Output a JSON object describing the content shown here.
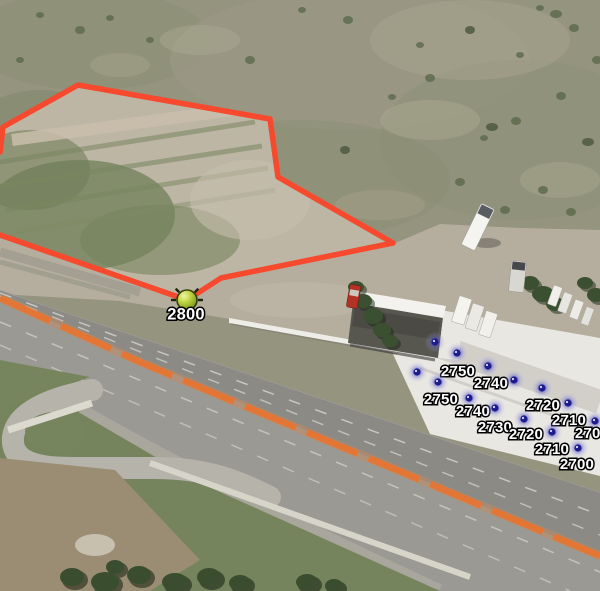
{
  "map": {
    "type": "satellite-aerial-view",
    "canvas": {
      "width": 600,
      "height": 591
    }
  },
  "colors": {
    "parcel_outline": "#f6492d",
    "elevation_marker_core": "#1c1c8e",
    "elevation_marker_glow": "#5656c6",
    "reference_marker_fill": "#abc437",
    "reference_marker_border": "#333f0c",
    "label_text": "#ffffff",
    "label_outline": "#000000",
    "highway_median_stripe": "#e8742f"
  },
  "parcel_outline": {
    "points": [
      [
        0,
        152
      ],
      [
        3,
        127
      ],
      [
        78,
        85
      ],
      [
        270,
        119
      ],
      [
        278,
        177
      ],
      [
        393,
        243
      ],
      [
        221,
        278
      ],
      [
        187,
        300
      ],
      [
        0,
        235
      ]
    ]
  },
  "reference_point": {
    "label": "2800",
    "x": 187,
    "y": 300,
    "label_x": 186,
    "label_y": 315
  },
  "elevation_points": [
    {
      "x": 435,
      "y": 342,
      "label": ""
    },
    {
      "x": 457,
      "y": 353,
      "label": "2750",
      "label_x": 458,
      "label_y": 372
    },
    {
      "x": 488,
      "y": 366,
      "label": "2740",
      "label_x": 491,
      "label_y": 384
    },
    {
      "x": 417,
      "y": 372,
      "label": ""
    },
    {
      "x": 438,
      "y": 382,
      "label": "2750",
      "label_x": 441,
      "label_y": 400
    },
    {
      "x": 514,
      "y": 380,
      "label": ""
    },
    {
      "x": 542,
      "y": 388,
      "label": "2720",
      "label_x": 543,
      "label_y": 406
    },
    {
      "x": 469,
      "y": 398,
      "label": "2740",
      "label_x": 473,
      "label_y": 412
    },
    {
      "x": 568,
      "y": 403,
      "label": "2710",
      "label_x": 569,
      "label_y": 421
    },
    {
      "x": 495,
      "y": 408,
      "label": "2730",
      "label_x": 495,
      "label_y": 428
    },
    {
      "x": 524,
      "y": 419,
      "label": "2720",
      "label_x": 526,
      "label_y": 435
    },
    {
      "x": 595,
      "y": 421,
      "label": "2700",
      "label_x": 592,
      "label_y": 434
    },
    {
      "x": 552,
      "y": 432,
      "label": "2710",
      "label_x": 552,
      "label_y": 450
    },
    {
      "x": 578,
      "y": 448,
      "label": "2700",
      "label_x": 577,
      "label_y": 465
    }
  ]
}
